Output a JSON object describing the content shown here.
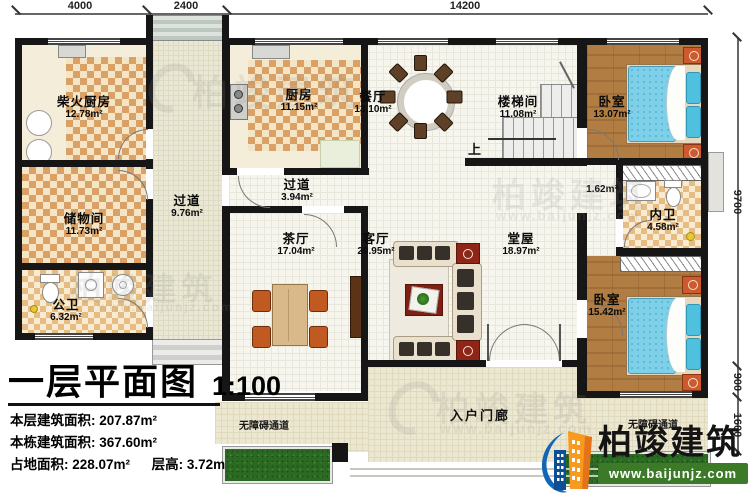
{
  "dims": {
    "top": [
      "4000",
      "2400",
      "14200"
    ],
    "right": [
      "9700",
      "900",
      "1600"
    ]
  },
  "rooms": {
    "chaihuo": {
      "name": "柴火厨房",
      "area": "12.78m²"
    },
    "chuwu": {
      "name": "储物间",
      "area": "11.73m²"
    },
    "gongwei": {
      "name": "公卫",
      "area": "6.32m²"
    },
    "guodao1": {
      "name": "过道",
      "area": "9.76m²"
    },
    "chufang": {
      "name": "厨房",
      "area": "11.15m²"
    },
    "guodao2": {
      "name": "过道",
      "area": "3.94m²"
    },
    "canting": {
      "name": "餐厅",
      "area": "13.10m²"
    },
    "louti": {
      "name": "楼梯间",
      "area": "11.08m²"
    },
    "woshi1": {
      "name": "卧室",
      "area": "13.07m²"
    },
    "nook": {
      "area": "1.62m²"
    },
    "neiwei": {
      "name": "内卫",
      "area": "4.58m²"
    },
    "chating": {
      "name": "茶厅",
      "area": "17.04m²"
    },
    "keting": {
      "name": "客厅",
      "area": "20.95m²"
    },
    "tangwu": {
      "name": "堂屋",
      "area": "18.97m²"
    },
    "woshi2": {
      "name": "卧室",
      "area": "15.42m²"
    },
    "porch": {
      "name": "入户门廊"
    },
    "ramp_left": {
      "name": "无障碍通道"
    },
    "ramp_right": {
      "name": "无障碍通道"
    }
  },
  "annotations": {
    "up": "上"
  },
  "title_block": {
    "title": "一层平面图",
    "scale": "1:100",
    "line1_label": "本层建筑面积:",
    "line1_value": "207.87m²",
    "line2_label": "本栋建筑面积:",
    "line2_value": "367.60m²",
    "line3_label": "占地面积:",
    "line3_value": "228.07m²",
    "line4_label": "层高:",
    "line4_value": "3.72m"
  },
  "logo": {
    "name": "柏竣建筑",
    "url": "www.baijunjz.com"
  },
  "watermark": {
    "text": "柏竣建筑",
    "url": "www.baijunjz.com"
  },
  "colors": {
    "wall": "#161616",
    "checker_tan": "#d9a166",
    "wood_floor": "#ab7940",
    "bed_blue": "#7ecfe8",
    "logo_blue": "#1266b4",
    "logo_orange": "#f79a1f",
    "banner_green": "#3c7a2a"
  }
}
